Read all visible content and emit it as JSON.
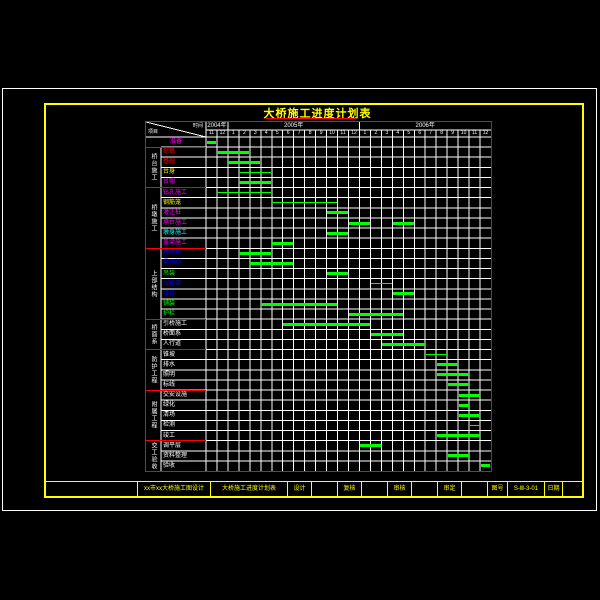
{
  "title": "大桥施工进度计划表",
  "corner": {
    "time_label": "时间",
    "project_label": "项目"
  },
  "colors": {
    "background": "#000000",
    "outer_frame": "#ffffff",
    "inner_frame": "#ffff00",
    "table_border": "#ff0000",
    "grid_line": "#ffffff",
    "bar": "#00ff00",
    "title": "#ffff00"
  },
  "chart_data": {
    "type": "gantt",
    "title": "大桥施工进度计划表",
    "years": [
      {
        "label": "2004年",
        "months": [
          "11",
          "12"
        ]
      },
      {
        "label": "2005年",
        "months": [
          "1",
          "2",
          "3",
          "4",
          "5",
          "6",
          "7",
          "8",
          "9",
          "10",
          "11",
          "12"
        ]
      },
      {
        "label": "2006年",
        "months": [
          "1",
          "2",
          "3",
          "4",
          "5",
          "6",
          "7",
          "8",
          "9",
          "10",
          "11",
          "12"
        ]
      }
    ],
    "groups": [
      {
        "label": "桥台施工",
        "from": 2,
        "to": 5
      },
      {
        "label": "桥墩施工",
        "from": 6,
        "to": 11
      },
      {
        "label": "上部结构",
        "from": 12,
        "to": 18
      },
      {
        "label": "桥面系",
        "from": 19,
        "to": 21
      },
      {
        "label": "防护工程",
        "from": 22,
        "to": 25
      },
      {
        "label": "附属工程",
        "from": 26,
        "to": 30
      },
      {
        "label": "交工验收",
        "from": 31,
        "to": 33
      }
    ],
    "tasks": [
      {
        "label": "准备",
        "color": "#ff00ff",
        "bars": [
          {
            "from": 1,
            "to": 1
          }
        ]
      },
      {
        "label": "挖基",
        "color": "#ff0000",
        "bars": [
          {
            "from": 2,
            "to": 4
          }
        ]
      },
      {
        "label": "基础",
        "color": "#ff0000",
        "bars": [
          {
            "from": 3,
            "to": 5
          }
        ]
      },
      {
        "label": "台身",
        "color": "#ffff00",
        "bars": [
          {
            "from": 4,
            "to": 6,
            "thin": true
          }
        ]
      },
      {
        "label": "台帽",
        "color": "#ff00ff",
        "bars": [
          {
            "from": 4,
            "to": 6
          }
        ]
      },
      {
        "label": "钻孔施工",
        "color": "#ff00ff",
        "bars": [
          {
            "from": 2,
            "to": 6,
            "thin": true
          }
        ]
      },
      {
        "label": "钢筋笼",
        "color": "#ffff00",
        "bars": [
          {
            "from": 7,
            "to": 12,
            "thin": true
          }
        ]
      },
      {
        "label": "灌注桩",
        "color": "#ff00ff",
        "bars": [
          {
            "from": 12,
            "to": 13
          }
        ]
      },
      {
        "label": "承台施工",
        "color": "#ff00ff",
        "bars": [
          {
            "from": 14,
            "to": 15
          },
          {
            "from": 18,
            "to": 19
          }
        ]
      },
      {
        "label": "墩身施工",
        "color": "#00ffff",
        "bars": [
          {
            "from": 12,
            "to": 13
          }
        ]
      },
      {
        "label": "盖梁施工",
        "color": "#ff00ff",
        "bars": [
          {
            "from": 7,
            "to": 8
          }
        ]
      },
      {
        "label": "预制场",
        "color": "#0000ff",
        "bars": [
          {
            "from": 4,
            "to": 6
          }
        ]
      },
      {
        "label": "梁预制",
        "color": "#0000ff",
        "bars": [
          {
            "from": 5,
            "to": 8
          }
        ]
      },
      {
        "label": "吊装",
        "color": "#00ff00",
        "bars": [
          {
            "from": 12,
            "to": 13
          }
        ]
      },
      {
        "label": "湿接缝",
        "color": "#0000ff",
        "bars": [
          {
            "from": 16,
            "to": 17,
            "thin": true
          }
        ]
      },
      {
        "label": "张拉",
        "color": "#0000ff",
        "bars": [
          {
            "from": 18,
            "to": 19
          }
        ]
      },
      {
        "label": "铺装",
        "color": "#00ff00",
        "bars": [
          {
            "from": 6,
            "to": 12
          }
        ]
      },
      {
        "label": "护栏",
        "color": "#00ff00",
        "bars": [
          {
            "from": 14,
            "to": 18
          }
        ]
      },
      {
        "label": "引桥施工",
        "color": "#ffffff",
        "bars": [
          {
            "from": 8,
            "to": 15
          }
        ]
      },
      {
        "label": "桥面系",
        "color": "#ffffff",
        "bars": [
          {
            "from": 16,
            "to": 18
          }
        ]
      },
      {
        "label": "人行道",
        "color": "#ffffff",
        "bars": [
          {
            "from": 17,
            "to": 20
          }
        ]
      },
      {
        "label": "锥坡",
        "color": "#ffffff",
        "bars": [
          {
            "from": 21,
            "to": 22,
            "thin": true
          }
        ]
      },
      {
        "label": "排水",
        "color": "#ffffff",
        "bars": [
          {
            "from": 22,
            "to": 23
          }
        ]
      },
      {
        "label": "照明",
        "color": "#ffffff",
        "bars": [
          {
            "from": 22,
            "to": 24
          }
        ]
      },
      {
        "label": "标线",
        "color": "#ffffff",
        "bars": [
          {
            "from": 23,
            "to": 24
          }
        ]
      },
      {
        "label": "交安设施",
        "color": "#ffffff",
        "bars": [
          {
            "from": 24,
            "to": 25
          }
        ]
      },
      {
        "label": "绿化",
        "color": "#ffffff",
        "bars": [
          {
            "from": 24,
            "to": 24
          }
        ]
      },
      {
        "label": "清场",
        "color": "#ffffff",
        "bars": [
          {
            "from": 24,
            "to": 25
          }
        ]
      },
      {
        "label": "检测",
        "color": "#ffffff",
        "bars": [
          {
            "from": 25,
            "to": 25,
            "thin": true
          }
        ]
      },
      {
        "label": "竣工",
        "color": "#ffffff",
        "bars": [
          {
            "from": 22,
            "to": 25
          }
        ]
      },
      {
        "label": "调平层",
        "color": "#ffffff",
        "bars": [
          {
            "from": 15,
            "to": 16
          }
        ]
      },
      {
        "label": "资料整理",
        "color": "#ffffff",
        "bars": [
          {
            "from": 23,
            "to": 24
          }
        ]
      },
      {
        "label": "验收",
        "color": "#ffffff",
        "bars": [
          {
            "from": 26,
            "to": 26
          }
        ]
      }
    ]
  },
  "footer": {
    "cells": [
      {
        "text": "",
        "w": 92
      },
      {
        "text": "xx市xx大桥施工图设计",
        "w": 73
      },
      {
        "text": "大桥施工进度计划表",
        "w": 77
      },
      {
        "text": "设计",
        "w": 24
      },
      {
        "text": "",
        "w": 26
      },
      {
        "text": "复核",
        "w": 24
      },
      {
        "text": "",
        "w": 26
      },
      {
        "text": "审核",
        "w": 24
      },
      {
        "text": "",
        "w": 26
      },
      {
        "text": "审定",
        "w": 24
      },
      {
        "text": "",
        "w": 26
      },
      {
        "text": "图号",
        "w": 20
      },
      {
        "text": "S-Ⅲ-3-01",
        "w": 37
      },
      {
        "text": "日期",
        "w": 18
      },
      {
        "text": "",
        "w": 19
      }
    ]
  }
}
